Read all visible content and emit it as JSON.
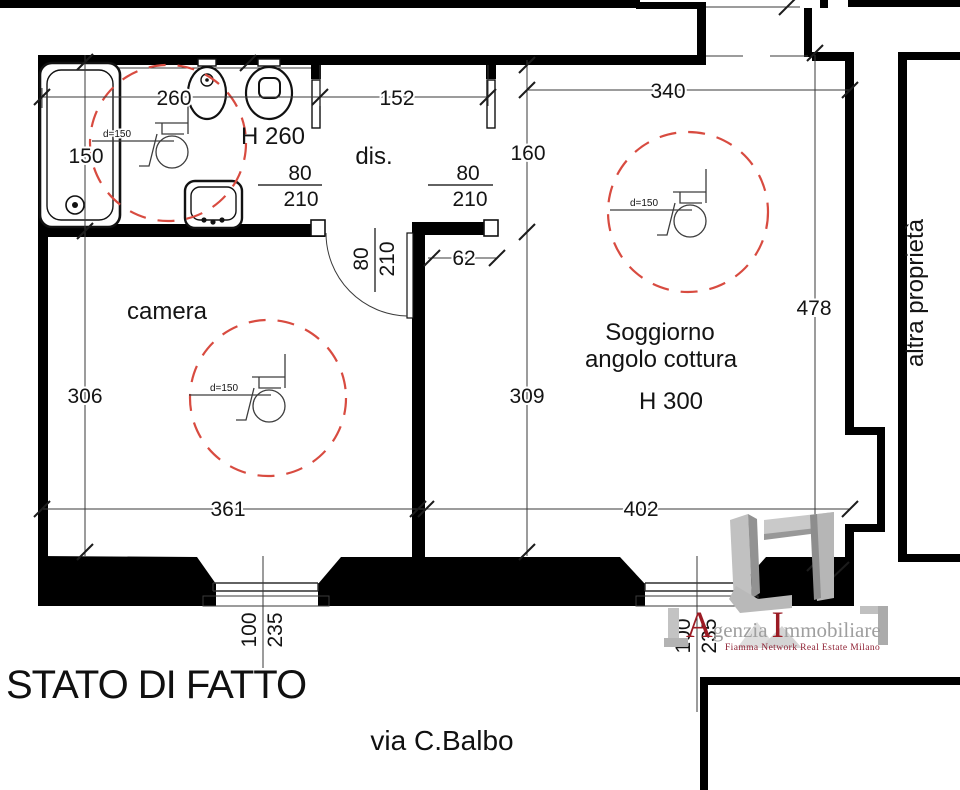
{
  "title": "STATO DI FATTO",
  "street": "via C.Balbo",
  "neighbor_label": "altra proprietà",
  "rooms": {
    "camera": "camera",
    "dis": "dis.",
    "soggiorno_line1": "Soggiorno",
    "soggiorno_line2": "angolo cottura",
    "soggiorno_height": "H 300",
    "bath_height": "H 260"
  },
  "dims": {
    "bath_width": "260",
    "tub_length": "150",
    "dis_width": "152",
    "sogg_top_width": "340",
    "dis_depth": "160",
    "camera_depth": "306",
    "camera_width": "361",
    "sogg_east_depth": "478",
    "sogg_west_depth": "309",
    "sogg_bottom_width": "402",
    "niche_width": "62"
  },
  "door": {
    "width": "80",
    "height": "210"
  },
  "window": {
    "width": "100",
    "height": "235"
  },
  "turning_circle_label": "d=150",
  "logo": {
    "initial1": "A",
    "word1": "genzia",
    "initial2": "I",
    "word2": "mmobiliare",
    "tagline": "Fiamma Network  Real Estate  Milano"
  },
  "colors": {
    "wall": "#000000",
    "dashed_circle": "#d84b40",
    "logo_gray": "#bdbdbd",
    "logo_red": "#9b1b24",
    "tagline_red": "#8e1f32"
  }
}
